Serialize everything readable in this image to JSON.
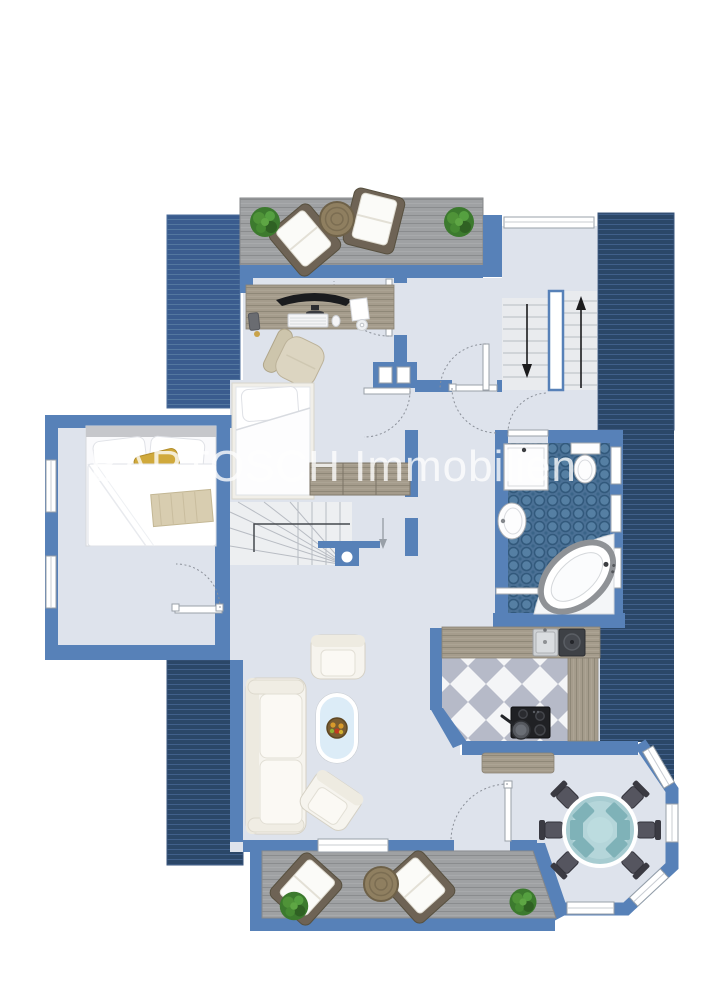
{
  "page": {
    "title": "Dachgeschoss"
  },
  "watermark": {
    "text": "BARTOSCH Immobilien"
  },
  "plan": {
    "type": "floor-plan",
    "floor": "Dachgeschoss",
    "stairs": [
      {
        "name": "main-staircase",
        "left_flight": "down",
        "right_flight": "up"
      },
      {
        "name": "winder-staircase",
        "direction": "down"
      }
    ],
    "areas": [
      {
        "name": "roof-terrace-top",
        "furniture": [
          "plant",
          "lounge-chair",
          "wicker-table",
          "lounge-chair",
          "plant"
        ]
      },
      {
        "name": "office",
        "furniture": [
          "desk",
          "monitor",
          "keyboard",
          "mouse",
          "papers",
          "cd",
          "phone",
          "office-chair"
        ]
      },
      {
        "name": "bedroom-left",
        "furniture": [
          "double-bed",
          "gold-pillow",
          "knit-blanket"
        ]
      },
      {
        "name": "bedroom-middle",
        "furniture": [
          "single-bed",
          "gold-pillow",
          "wardrobe"
        ]
      },
      {
        "name": "bathroom",
        "furniture": [
          "shower",
          "toilet",
          "washbasin",
          "corner-bathtub",
          "towel-rail"
        ]
      },
      {
        "name": "kitchen",
        "furniture": [
          "countertop",
          "sink",
          "dark-basin",
          "cooktop",
          "pan",
          "sideboard"
        ]
      },
      {
        "name": "living-room",
        "furniture": [
          "sofa",
          "armchair",
          "coffee-table",
          "fruit-bowl",
          "armchair"
        ]
      },
      {
        "name": "dining-bay",
        "furniture": [
          "round-glass-table",
          "chair",
          "chair",
          "chair",
          "chair",
          "chair",
          "chair"
        ]
      },
      {
        "name": "terrace-bottom",
        "furniture": [
          "plant",
          "lounge-chair",
          "wicker-table",
          "lounge-chair",
          "plant"
        ]
      }
    ]
  },
  "colors": {
    "wall": "#5781b8",
    "roof_dark": "#2b4768",
    "roof_dark_line": "#41608a",
    "roof_med": "#3a5c8e",
    "roof_med_line": "#53779f",
    "floor": "#dee3ec",
    "deck": "#9fa1a3",
    "deck_line": "#8a8c8e",
    "tile_base": "#4a7095",
    "tile_dot": "#557fa3",
    "wood": "#a59c8c",
    "wood_line": "#8f8878",
    "stair_tread": "#e9ebee",
    "stair_line": "#b8bcc3",
    "glass_teal": "#a7ccd1",
    "chair_dark": "#45454d",
    "sofa_white": "#f6f4ee",
    "gold": "#d0a93c",
    "plant_green": "#3c7a2e",
    "title_text": "#3b3b3d",
    "watermark_white": "#ffffff"
  }
}
